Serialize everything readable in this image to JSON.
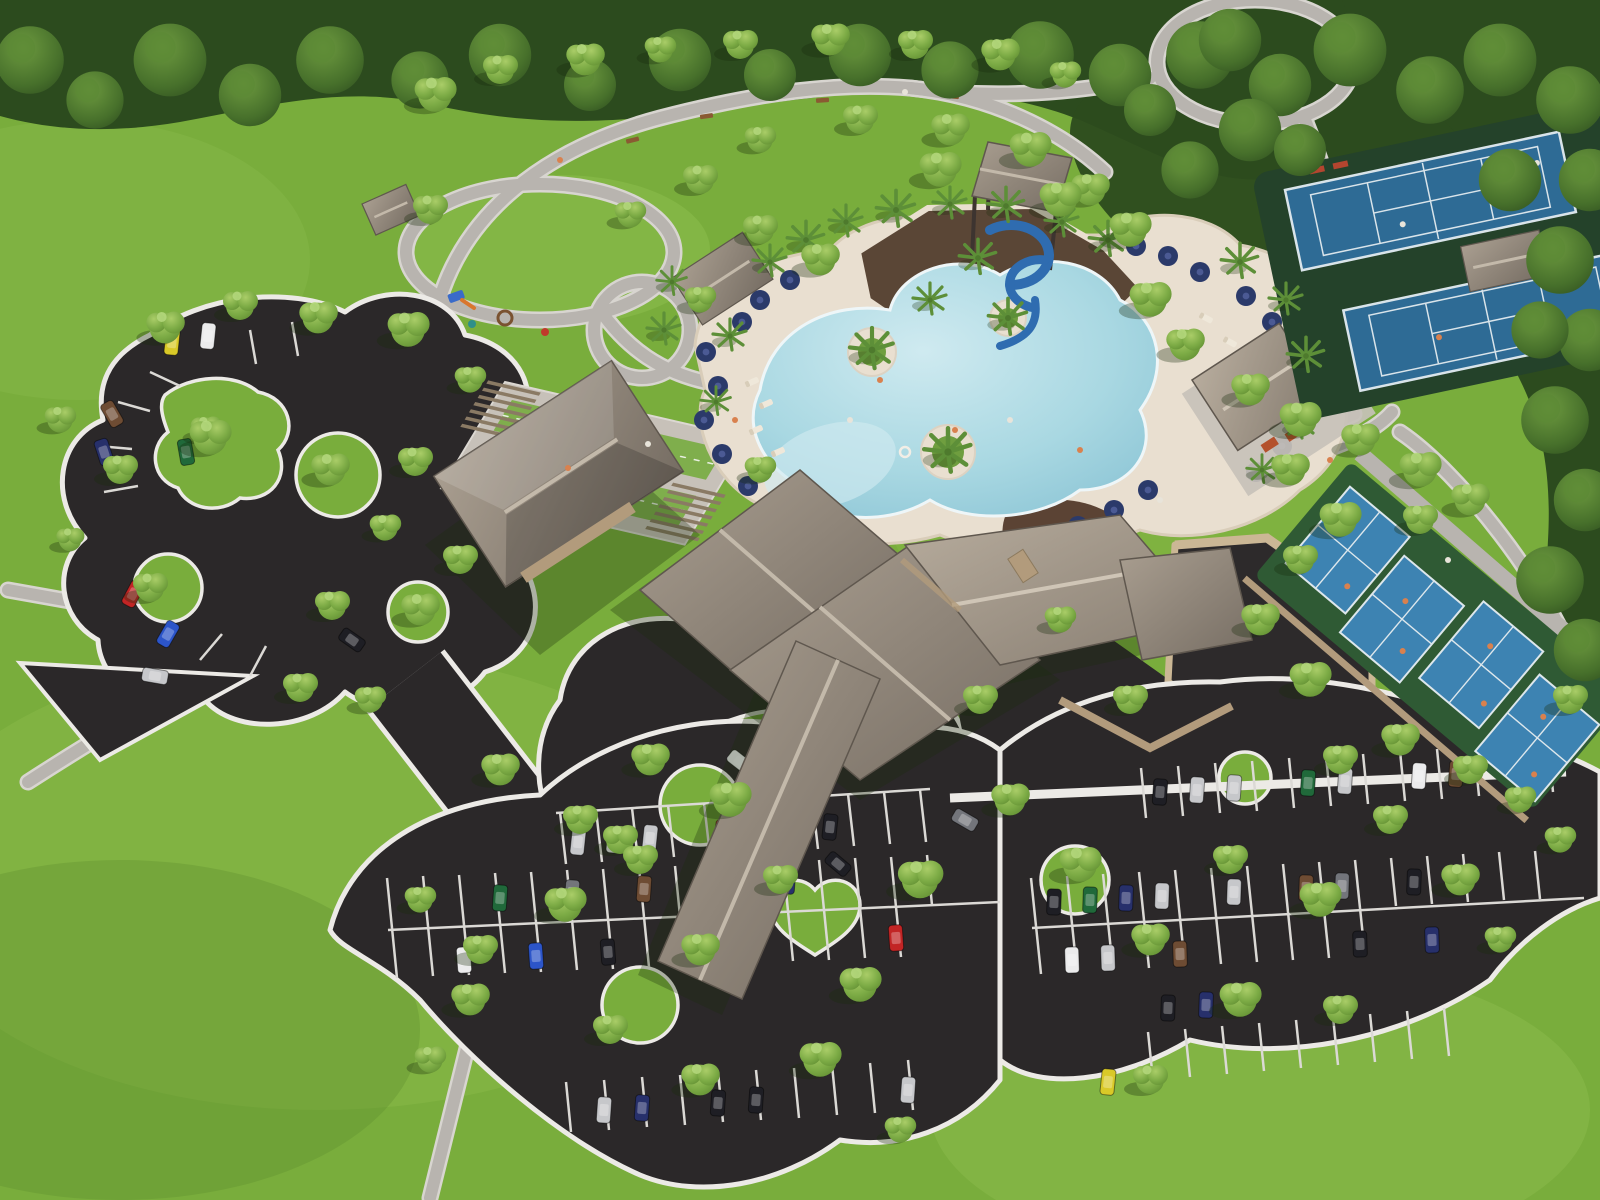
{
  "scene": {
    "type": "aerial-3d-architectural-rendering",
    "subject": "community amenity center and park site",
    "features": [
      {
        "label": "perimeter forest",
        "count": 1
      },
      {
        "label": "walking trail loops",
        "count": 3
      },
      {
        "label": "playground",
        "count": 1
      },
      {
        "label": "bocce lawn courts",
        "count": 2
      },
      {
        "label": "bocce pergolas",
        "count": 2
      },
      {
        "label": "resort lagoon pool",
        "count": 1
      },
      {
        "label": "water slide tower",
        "count": 1
      },
      {
        "label": "pool umbrellas",
        "count": 29
      },
      {
        "label": "palm trees",
        "count": 22
      },
      {
        "label": "clubhouse building",
        "count": 1
      },
      {
        "label": "fitness annex building",
        "count": 1
      },
      {
        "label": "restroom building",
        "count": 1
      },
      {
        "label": "porte-cochere drop-off loop",
        "count": 1
      },
      {
        "label": "picnic pavilion",
        "count": 2
      },
      {
        "label": "tennis courts",
        "count": 2
      },
      {
        "label": "pickleball courts",
        "count": 4
      },
      {
        "label": "walled service courtyard",
        "count": 1
      },
      {
        "label": "organic parking lot",
        "count": 1
      },
      {
        "label": "main parking lots",
        "count": 2
      },
      {
        "label": "parked cars",
        "count": 58
      },
      {
        "label": "shade trees",
        "count": 80
      }
    ]
  },
  "palette": {
    "lawn": "#79ad3c",
    "lawnLight": "#94c253",
    "lawnDark": "#55842c",
    "forest": "#2c4b1e",
    "canopy": "#76a53f",
    "canopyLight": "#a3ca63",
    "path": "#b8b4af",
    "pathEdge": "#d8d5d0",
    "curb": "#eceae6",
    "asphalt": "#2b2829",
    "stripe": "#dbd9d5",
    "deck": "#e9dfd0",
    "deckEdge": "#d9cdb9",
    "water": "#a9d8e2",
    "waterDeep": "#7fbcd0",
    "waterLight": "#cfeaf0",
    "navy": "#2b3a6a",
    "navyLight": "#4b5a94",
    "roof": "#8f857a",
    "roofDark": "#6c635a",
    "roofLight": "#b3a99b",
    "stone": "#b29b7c",
    "stoneLight": "#cbb795",
    "slideBlue": "#2f6cb0",
    "rubber": "#5a4636",
    "tennisBlue": "#2e6b95",
    "tennisGreen": "#24422a",
    "courtLine": "#e8eef2",
    "pbBlue": "#3d83b2",
    "pbGreen": "#2f5a34",
    "bocceGreen": "#7fae4c",
    "pad": "#c7c1b9",
    "pergola": "#8a7a64",
    "palm": "#5d8f38",
    "terrace": "#5b4334",
    "benchRed": "#b4452f",
    "tableOrange": "#b4512c",
    "person": "#d9814e",
    "personWhite": "#e8e4da",
    "carSilver": "#c6c7ca",
    "carWhite": "#ebebec",
    "carBlack": "#1e1e24",
    "carGray": "#73757b",
    "carRed": "#c22525",
    "carBlue": "#2c55c9",
    "carNavy": "#27306b",
    "carGreen": "#20693a",
    "carYellow": "#d9c928",
    "carBrown": "#6e4c33"
  }
}
